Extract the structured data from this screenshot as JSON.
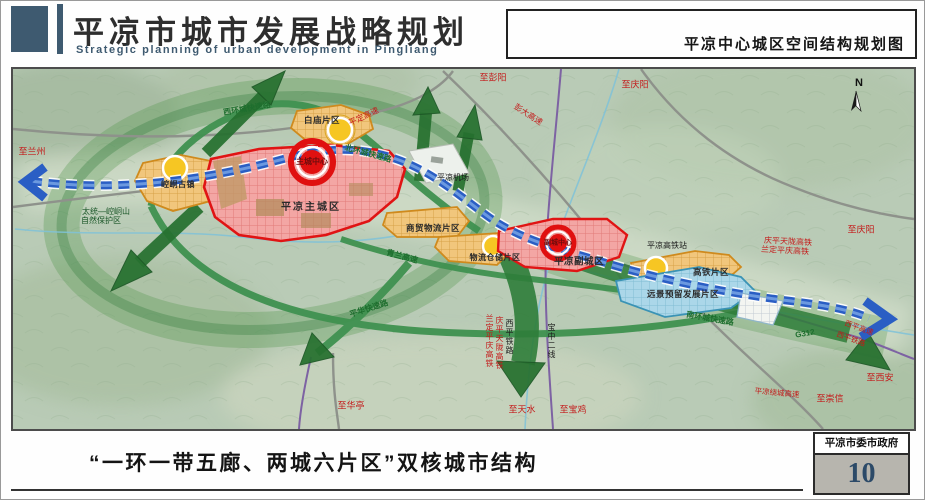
{
  "header": {
    "title": "平凉市城市发展战略规划",
    "subtitle": "Strategic planning of urban development in Pingliang",
    "map_title": "平凉中心城区空间结构规划图"
  },
  "map": {
    "compass": "N",
    "zones": {
      "main_city": "平凉主城区",
      "main_core": "主城中心",
      "sub_city": "平凉副城区",
      "sub_core": "副城中心",
      "baimiao": "白庙片区",
      "kongtong": "崆峒古镇",
      "trade_logistics": "商贸物流片区",
      "logistics_storage": "物流仓储片区",
      "hsr": "高铁片区",
      "reserve": "远景预留发展片区"
    },
    "roads": {
      "west_ring": "西环城快速路",
      "north_ring": "北环城快速路",
      "south_ring": "南环城快速路",
      "pinghua": "平华快速路",
      "qinglan": "青兰高速",
      "pengda": "彭大高速",
      "pingding": "平定高速",
      "g312": "G312",
      "xiping_expwy": "西平高速",
      "ring_expwy": "平凉绕城高速"
    },
    "railways": {
      "qpt_hsr": "庆平天陇高铁",
      "ldpq_hsr": "兰定平庆高铁",
      "xiping_rail": "西平铁路",
      "baozhong2": "宝中二线"
    },
    "stations": {
      "hsr_station": "平凉高铁站",
      "airport": "平凉机场"
    },
    "directions": {
      "lanzhou": "至兰州",
      "pengyang": "至彭阳",
      "qingyang": "至庆阳",
      "xian": "至西安",
      "chongxin": "至崇信",
      "huating": "至华亭",
      "tianshui": "至天水",
      "baoji": "至宝鸡"
    },
    "nature": {
      "reserve_line1": "太统—崆峒山",
      "reserve_line2": "自然保护区"
    }
  },
  "footer": {
    "caption": "“一环一带五廊、两城六片区”双核城市结构",
    "org": "平凉市委市政府",
    "page": "10"
  },
  "colors": {
    "accent_blue": "#3e5a70",
    "core_red": "#e01010",
    "belt_blue": "#2a5ec4",
    "label_red": "#c41a1a",
    "label_green": "#1e6e2e",
    "page_num_blue": "#2c4a68"
  }
}
